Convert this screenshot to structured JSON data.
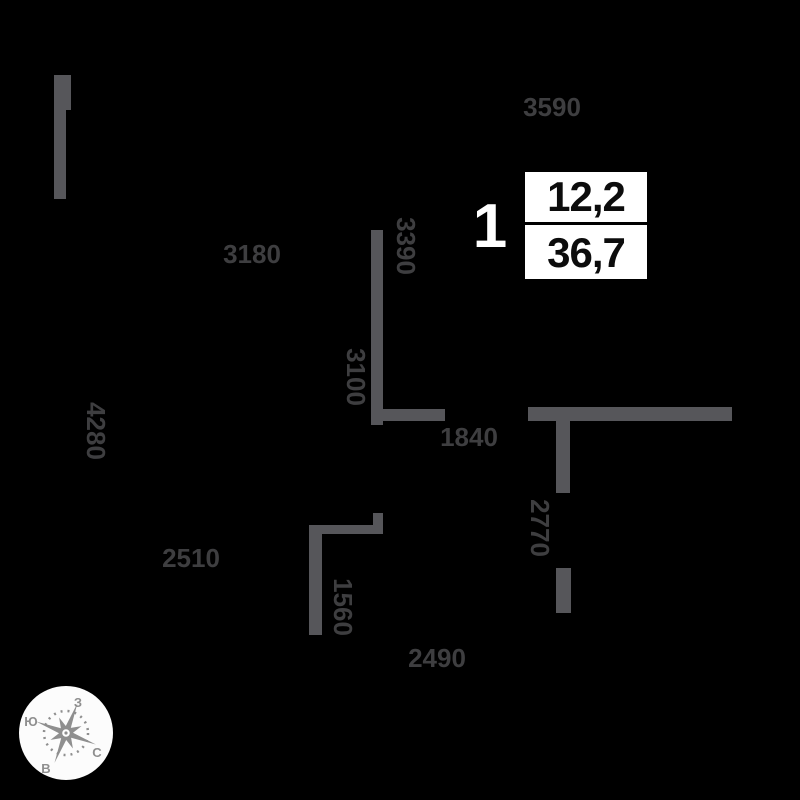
{
  "colors": {
    "background": "#000000",
    "wall": "#56565a",
    "dimension_text": "#3e3e40",
    "unit_number_text": "#ffffff",
    "area_box_background": "#ffffff",
    "area_box_text": "#0c0c0c",
    "compass_gray": "#8f8f8f"
  },
  "unit": {
    "number": "1",
    "area_top": "12,2",
    "area_bottom": "36,7"
  },
  "dimensions": [
    {
      "value": "3590",
      "orientation": "horizontal"
    },
    {
      "value": "3180",
      "orientation": "horizontal"
    },
    {
      "value": "3390",
      "orientation": "vertical"
    },
    {
      "value": "3100",
      "orientation": "vertical"
    },
    {
      "value": "4280",
      "orientation": "vertical"
    },
    {
      "value": "1840",
      "orientation": "horizontal"
    },
    {
      "value": "2770",
      "orientation": "vertical"
    },
    {
      "value": "2510",
      "orientation": "horizontal"
    },
    {
      "value": "1560",
      "orientation": "vertical"
    },
    {
      "value": "2490",
      "orientation": "horizontal"
    }
  ],
  "compass": {
    "west_label": "З",
    "south_label": "Ю",
    "north_label": "С",
    "east_label": "В"
  }
}
